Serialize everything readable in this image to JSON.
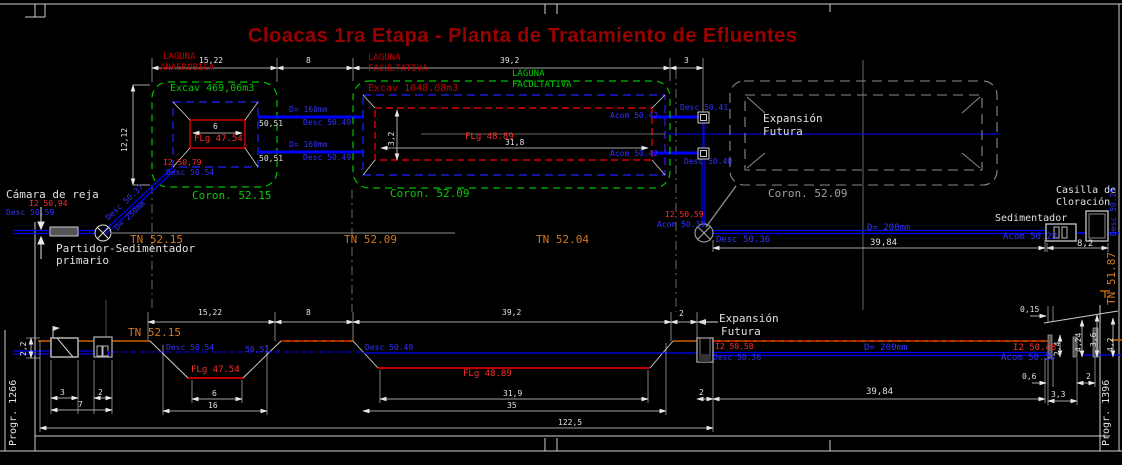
{
  "title": "Cloacas 1ra Etapa - Planta de Tratamiento de Efluentes",
  "plan": {
    "anaerobica": {
      "label1": "LAGUNA",
      "label2": "ANAEROBICA",
      "excav": "Excav 469,06m3",
      "flg": "FLg 47.54",
      "i2": "I2 50,79",
      "desc": "Desc 50.54",
      "coron": "Coron. 52.15",
      "dim_width": "15,22",
      "dim_height": "12,12",
      "dim_bottom": "6"
    },
    "gap_dim": "8",
    "pipe_top": {
      "d": "D= 160mm",
      "desc": "Desc 50.49",
      "level": "50,51"
    },
    "pipe_bottom": {
      "d": "D= 160mm",
      "desc": "Desc 50.49",
      "level": "50,51"
    },
    "facultativa": {
      "label1": "LAGUNA",
      "label2": "FACULTATIVA",
      "label3": "LAGUNA",
      "label4": "FACULTATIVA",
      "excav": "Excav 1048.08m3",
      "flg": "FLg 48.89",
      "dim_width": "39,2",
      "dim_len": "31,8",
      "dim_depth": "3,2",
      "acom_top": "Acom 50.42",
      "acom_bottom": "Acom 50.42",
      "coron": "Coron. 52.09"
    },
    "outlet": {
      "dim": "3",
      "desc_top": "Desc 50.41",
      "desc_bottom": "Desc 50.40"
    },
    "expansion": {
      "label1": "Expansión",
      "label2": "Futura",
      "coron": "Coron. 52.09"
    }
  },
  "axis": {
    "camara": "Cámara de reja",
    "camara_i2": "I2 50,94",
    "camara_desc": "Desc 50,59",
    "partidor1": "Partidor-Sedimentador",
    "partidor2": "primario",
    "inlet_desc": "Desc 50.37",
    "inlet_d": "D= 250mm",
    "tn_1": "TN 52.15",
    "tn_2": "TN 52.09",
    "tn_3": "TN 52.04",
    "mh_i2": "I2 50.59",
    "mh_acom": "Acom 50.39",
    "pipe_desc": "Desc 50.36",
    "pipe_d": "D= 200mm",
    "dim": "39,84",
    "sedimentador": "Sedimentador",
    "sed_acom": "Acom 50.28",
    "casilla1": "Casilla de",
    "casilla2": "Cloración",
    "casilla_desc": "Desc 50.25",
    "dim_sed": "8,2",
    "tn_right": "TN 51.87"
  },
  "profile": {
    "dim_1522": "15,22",
    "dim_8": "8",
    "dim_392": "39,2",
    "dim_2": "2",
    "dim_015": "0,15",
    "tn": "TN 52.15",
    "desc_5054": "Desc 50.54",
    "level_5051": "50,51",
    "flg_anae": "FLg 47.54",
    "dim_6": "6",
    "dim_16": "16",
    "desc_5049": "Desc 50.49",
    "flg_fac": "FLg 48.89",
    "dim_319": "31,9",
    "dim_35": "35",
    "dim_1225": "122,5",
    "exp1": "Expansión",
    "exp2": "Futura",
    "i2_5058": "I2 50.58",
    "desc_5036": "Desc 50.36",
    "d200": "D= 200mm",
    "dim_3984": "39,84",
    "dim_2b": "2",
    "left": {
      "dim_22": "2,2",
      "dim_3": "3",
      "dim_2": "2",
      "dim_7": "7",
      "progr": "Progr. 1266"
    },
    "right": {
      "i2": "I2 50.48",
      "acom": "Acom 50.28",
      "dim_24": "2,4",
      "dim_424": "4,24",
      "dim_36": "3,6",
      "dim_42": "4,2",
      "dim_06": "0,6",
      "dim_33": "3,3",
      "dim_2": "2",
      "progr": "Progr. 1396"
    }
  }
}
